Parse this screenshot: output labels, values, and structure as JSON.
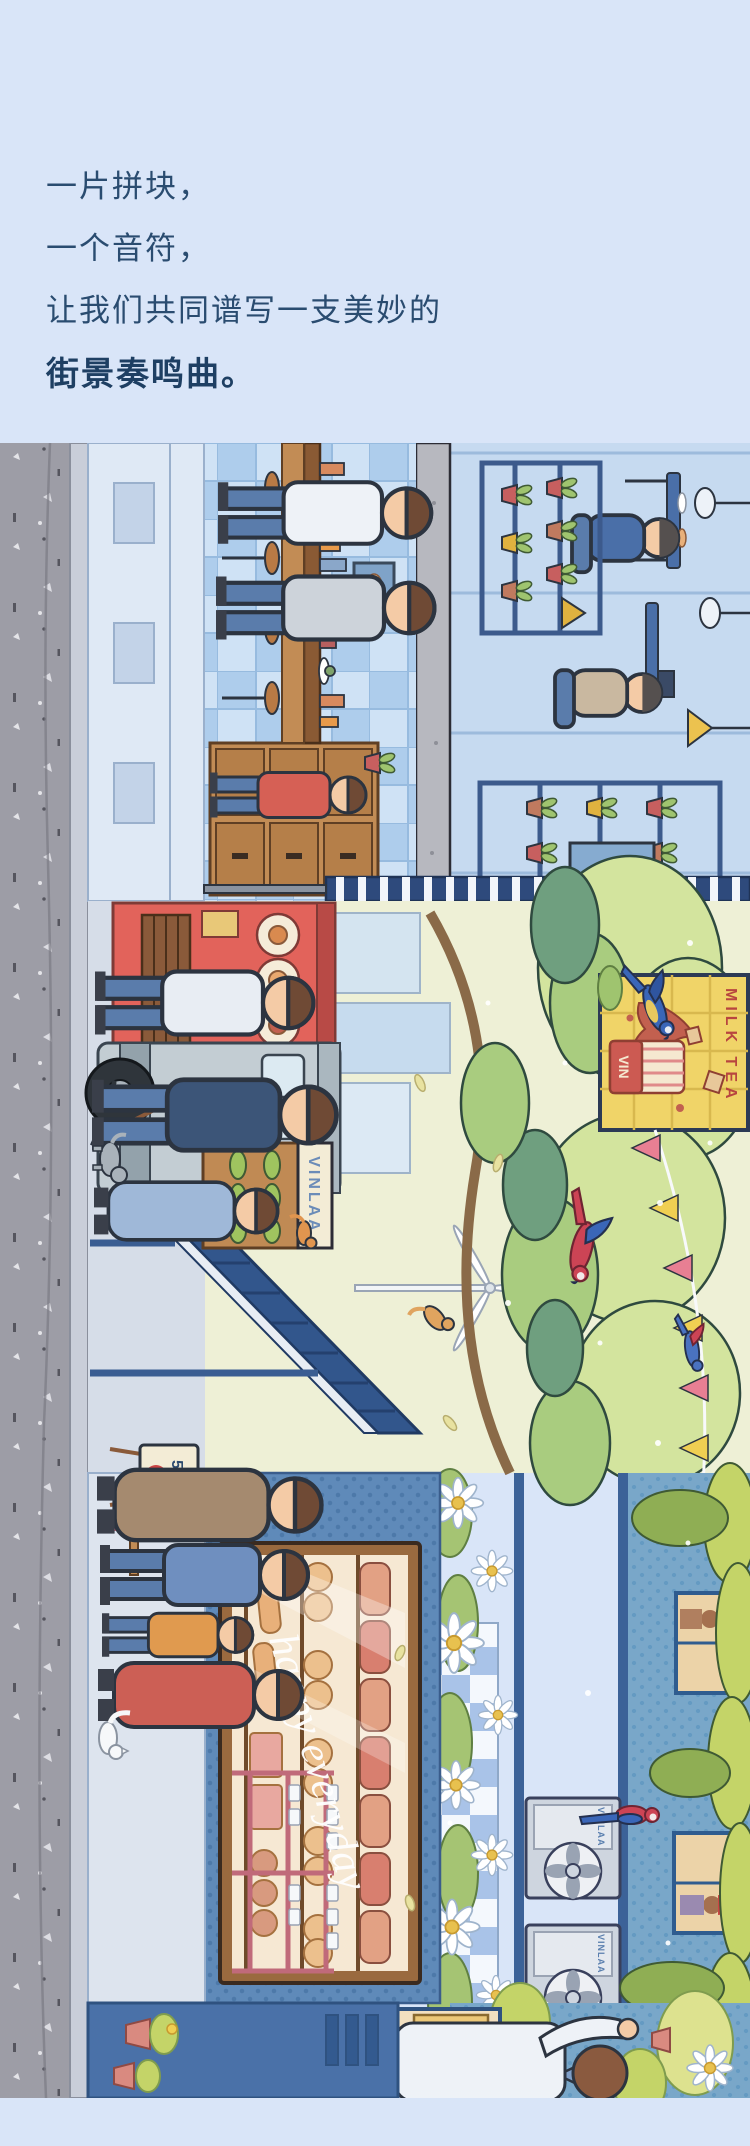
{
  "page": {
    "width": 750,
    "height": 2146,
    "background": "#d9e5f8"
  },
  "hero": {
    "lines": [
      "一片拼块，",
      "一个音符，",
      "让我们共同谱写一支美妙的"
    ],
    "headline_bold": "街景奏鸣曲。",
    "watermark": "CITY LEISURE COZINESS",
    "text_color": "#2a4c70",
    "bold_color": "#1e3f63",
    "watermark_color": "#bfd0e8"
  },
  "illustration": {
    "alt": "Rotated cutaway street scene: cafe interior with tiled wall, upstairs plant room, red food stall, gray van, trees with parrots, milk tea billboard, bunting flags, bakery bread display, AC units, daisy beds and a blue kiosk",
    "signs": {
      "shop_sign": "VINLAA",
      "billboard_title": "MILK TEA",
      "billboard_cup_label": "VIN",
      "promo_percent": "50%",
      "promo_word": "off",
      "window_script": "happy everyday",
      "ac_unit_brand": "VINLAA"
    },
    "palette": {
      "road": "#9d9da6",
      "tile_light": "#cfe2f5",
      "tile_dark": "#aecdec",
      "stall_red": "#e2635b",
      "tree_light": "#d3e49e",
      "tree_mid": "#a9cc7f",
      "tree_dark": "#6f9f7f",
      "billboard_yellow": "#f0d468",
      "flag_pink": "#e87f93",
      "flag_yellow": "#f0cf52",
      "bakery_wall": "#5f8ab9",
      "bread_warm": "#ecc08d",
      "ac_gray": "#ced5df",
      "kiosk_blue": "#4a71a8"
    }
  }
}
